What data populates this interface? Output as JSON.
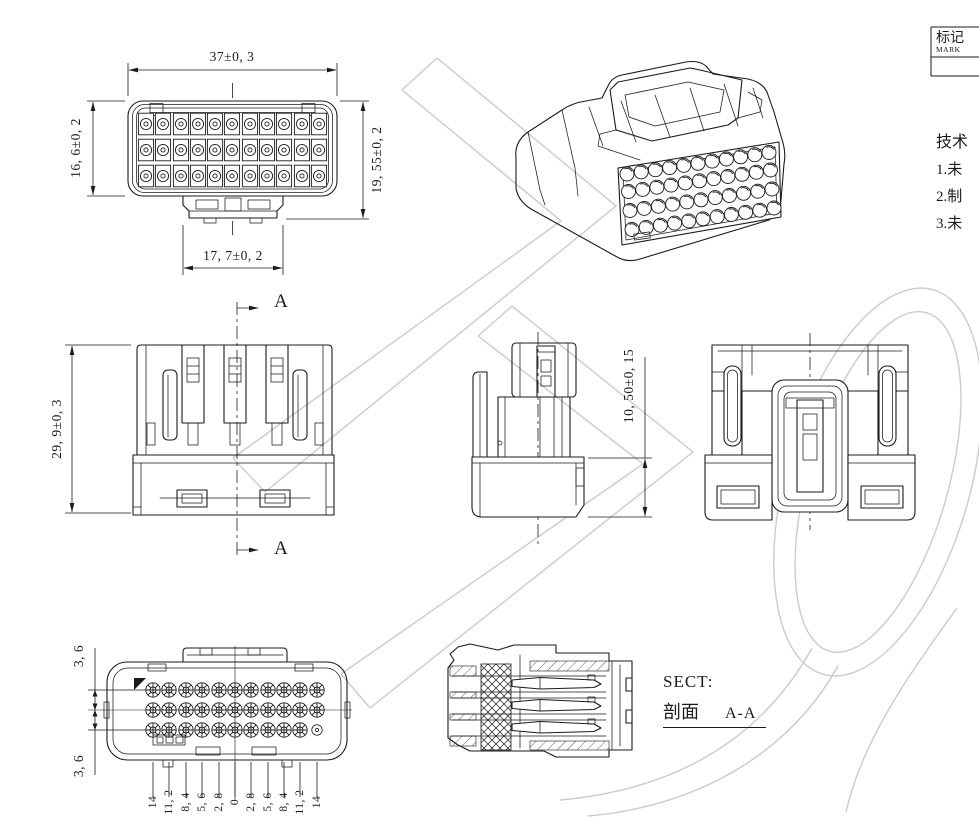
{
  "colors": {
    "line": "#1b1b1b",
    "watermark": "#cbcbcb",
    "background": "#ffffff"
  },
  "title_block": {
    "mark_cn": "标记",
    "mark_en": "MARK"
  },
  "tech_notes": {
    "heading": "技术",
    "item_1": "1.未",
    "item_2": "2.制",
    "item_3": "3.未"
  },
  "front_view": {
    "dim_width": "37±0, 3",
    "dim_height_left": "16, 6±0, 2",
    "dim_height_right": "19, 55±0, 2",
    "dim_tab_width": "17, 7±0, 2"
  },
  "side_view": {
    "dim_height": "29, 9±0, 3",
    "section_arrow_top": "A",
    "section_arrow_bottom": "A"
  },
  "middle_view": {
    "dim_height": "10, 50±0, 15"
  },
  "pin_view": {
    "dim_row_pitch_top": "3, 6",
    "dim_row_pitch_bottom": "3, 6",
    "pin_columns": [
      "14",
      "11, 2",
      "8, 4",
      "5, 6",
      "2, 8",
      "0",
      "2, 8",
      "5, 6",
      "8, 4",
      "11, 2",
      "14"
    ]
  },
  "section_view": {
    "label_sect": "SECT:",
    "label_cn": "剖面",
    "label_ref": "A-A"
  }
}
